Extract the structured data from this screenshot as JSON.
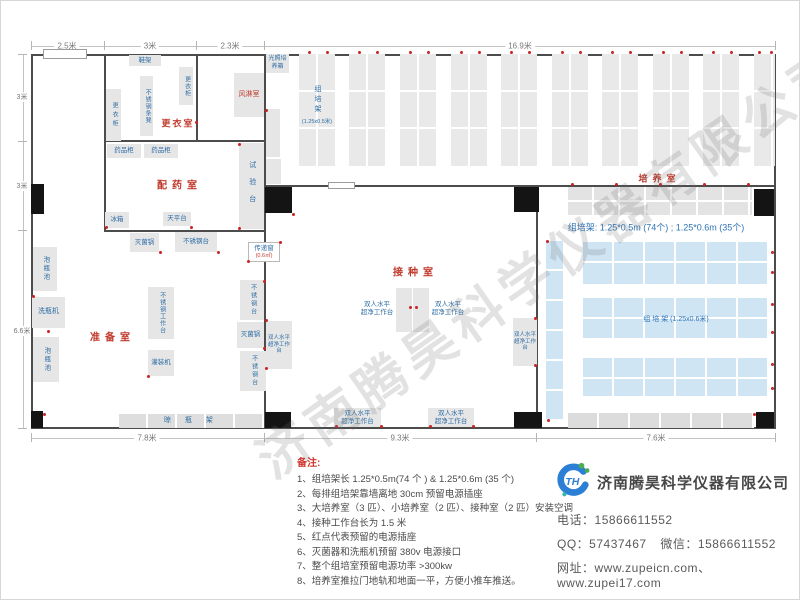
{
  "dimensions": {
    "top": [
      "2.5米",
      "3米",
      "2.3米",
      "16.9米"
    ],
    "left": [
      "3米",
      "3米",
      "6.6米"
    ],
    "bottom": [
      "7.8米",
      "9.3米",
      "7.6米"
    ]
  },
  "rooms": {
    "changing_room": "更衣室",
    "air_shower": "风淋室",
    "dispensing_room": "配药室",
    "prep_room": "准备室",
    "inoculation_room": "接种室",
    "culture_room": "培养室"
  },
  "equipment": {
    "shoe_rack": "鞋架",
    "wardrobe": "更衣柜",
    "steel_strip_bench": "不锈钢条凳",
    "light_incubator": "光照培养箱",
    "medicine_cabinet": "药品柜",
    "test_bench": "试验台",
    "fridge": "冰箱",
    "balance_table": "天平台",
    "sterilizer": "灭菌锅",
    "steel_table": "不锈钢台",
    "steel_workbench": "不锈钢工作台",
    "bottle_pool": "泡瓶池",
    "bottle_washer": "洗瓶机",
    "filling_machine": "灌装机",
    "drying_rack": "晾 瓶 架",
    "transfer_window": "传递窗",
    "transfer_window_size": "(0.6㎡)",
    "clean_bench_line1": "双人水平",
    "clean_bench_line2": "超净工作台",
    "tc_rack": "组培架",
    "tc_rack_small_size": "(1.25x0.5米)",
    "tc_rack_big_label": "组  培  架 (1.25x0.6米)"
  },
  "annotations": {
    "rack_summary": "组培架: 1.25*0.5m (74个) ; 1.25*0.6m (35个)"
  },
  "notes": {
    "title": "备注:",
    "items": [
      "1、组培架长 1.25*0.5m(74 个 ) & 1.25*0.6m (35 个)",
      "2、每排组培架靠墙离地 30cm 预留电源插座",
      "3、大培养室（3 匹）、小培养室（2 匹）、接种室（2 匹）安装空调",
      "4、接种工作台长为 1.5 米",
      "5、红点代表预留的电源插座",
      "6、灭菌器和洗瓶机预留 380v 电源接口",
      "7、整个组培室预留电源功率 >300kw",
      "8、培养室推拉门地轨和地面一平，方便小推车推送。"
    ]
  },
  "company": {
    "logo_text": "TH",
    "name": "济南腾昊科学仪器有限公司",
    "phone_label": "电话：",
    "phone": "15866611552",
    "qq_label": "QQ：",
    "qq": "57437467",
    "wechat_label": "微信：",
    "wechat": "15866611552",
    "web_label": "网址：",
    "website1": "www.zupeicn.com",
    "website_sep": "、",
    "website2": "www.zupei17.com"
  },
  "watermark": "济南腾昊科学仪器有限公司",
  "colors": {
    "room_label": "#c0392b",
    "equipment_label": "#2e6da5",
    "gray_rack_fill": "#e9e9e9",
    "blue_rack_fill": "#cfe5f4",
    "wall": "#4c4c4c",
    "door": "#141414",
    "power_dot": "#cc2222"
  }
}
